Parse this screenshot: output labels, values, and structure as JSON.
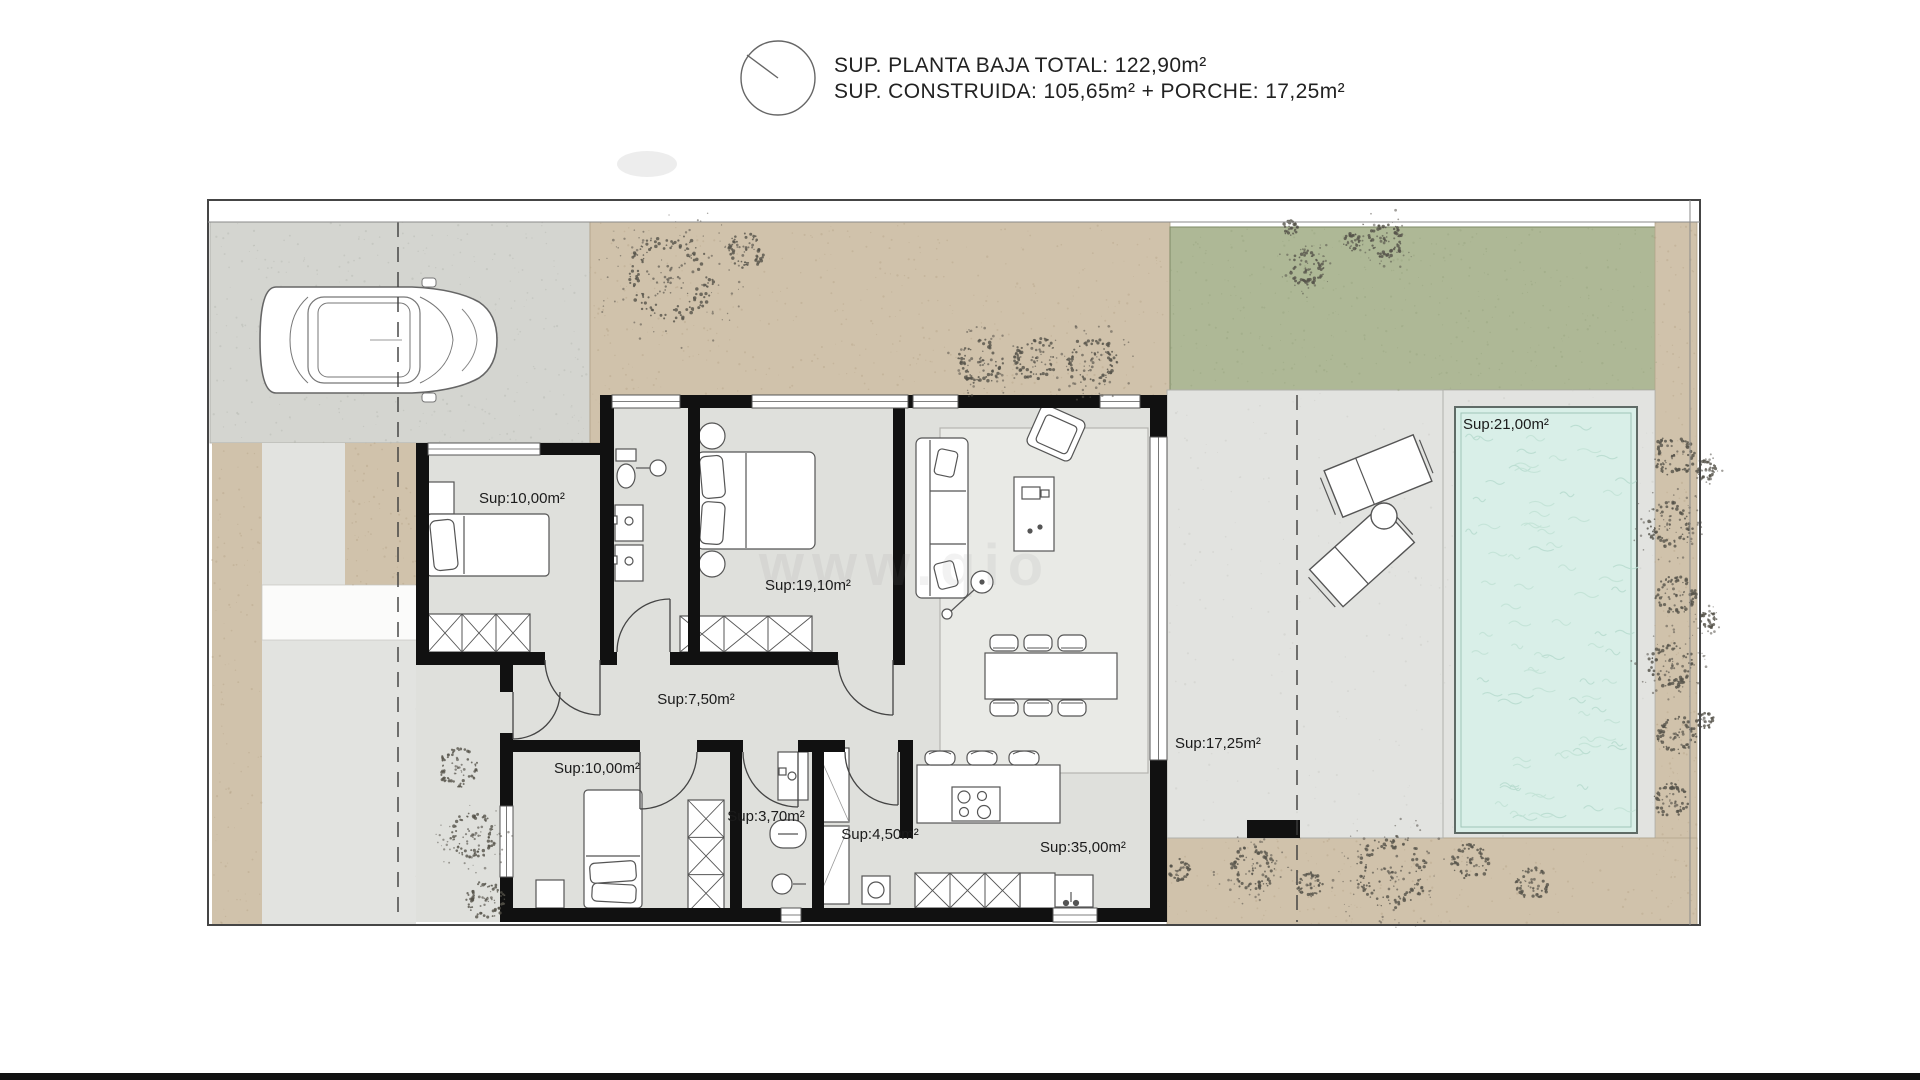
{
  "header": {
    "title_line1": "SUP. PLANTA BAJA TOTAL: 122,90m²",
    "title_line2": "SUP. CONSTRUIDA: 105,65m² + PORCHE: 17,25m²"
  },
  "rooms": {
    "bedroom1": "Sup:10,00m²",
    "master_bedroom": "Sup:19,10m²",
    "hallway": "Sup:7,50m²",
    "bedroom2": "Sup:10,00m²",
    "bathroom1": "Sup:3,70m²",
    "bathroom2": "Sup:4,50m²",
    "kitchen_living": "Sup:35,00m²",
    "porch": "Sup:17,25m²",
    "pool": "Sup:21,00m²"
  },
  "watermark": "www.qio",
  "colors": {
    "walls": "#111111",
    "lawn": "#aeb896",
    "sand": "#d0c2ab",
    "paving": "#d4d5d0",
    "interior_floor": "#dfe0dc",
    "terrace": "#e2e3e0",
    "pool_water": "#d9efe8"
  }
}
